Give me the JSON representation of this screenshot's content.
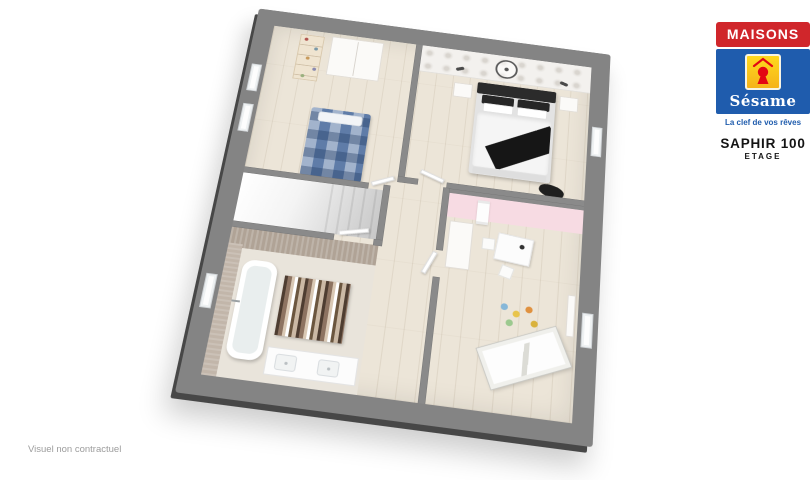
{
  "branding": {
    "logo": {
      "name_top": "MAISONS",
      "name_bottom": "Sésame",
      "tagline": "La clef de vos rêves",
      "colors": {
        "red": "#d0262b",
        "blue": "#1f5cad",
        "yellow": "#ffd203",
        "keyhole": "#e30613"
      }
    },
    "model_name": "SAPHIR 100",
    "model_level": "ETAGE"
  },
  "footer": {
    "disclaimer": "Visuel non contractuel"
  },
  "floorplan": {
    "view": "3d-perspective-floor-plan",
    "frame_color": "#848484",
    "floor_color": "#ece5d8",
    "rooms": [
      {
        "name": "bedroom-blue-bed",
        "accent_color": "#5f7ca8"
      },
      {
        "name": "master-bedroom",
        "accent_color": "#2b2b2b"
      },
      {
        "name": "stairwell",
        "accent_color": "#d9d9d9"
      },
      {
        "name": "bathroom",
        "accent_color": "#b0a396"
      },
      {
        "name": "child-bedroom",
        "accent_color": "#f7dbe3"
      },
      {
        "name": "landing-hallway",
        "accent_color": "#ece5d8"
      }
    ]
  }
}
